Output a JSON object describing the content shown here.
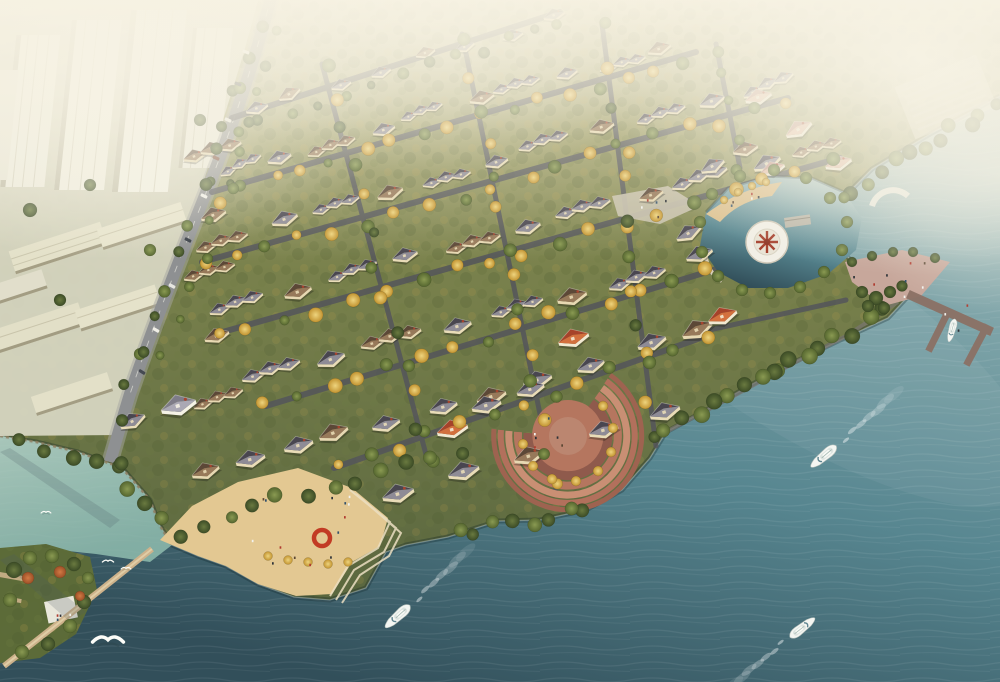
{
  "scene": {
    "title": "Aerial rendering of a lakeside villa community",
    "description": "Bird's-eye architectural visualization in hazy autumn light: a dense European-style villa estate on a promontory surrounded by teal water, with a high-rise city district to the upper left, golden tree-lined streets, a waterfront amphitheater, a beach plaza with a red ring sculpture, a circular lagoon viewing platform, a boat dock, yachts with wakes and seagulls over the water.",
    "regions": {
      "upper_left": "hazy high-rise towers and mid-rise apartment slabs beside a curving arterial road",
      "center": "grid of gabled villas and townhouses with rows of golden autumn trees",
      "upper_right": "fog-covered manor houses with pink roofs and terraced lot",
      "right": "inner lagoon with circular platform, pink waterfront plaza, promontory point and T-shaped boat dock",
      "lower_center": "crescent waterfront amphitheater with terracotta steps",
      "lower_left": "sandy beach plaza, red ring sculpture, boardwalk, small tree park peninsula and cove"
    },
    "objects": {
      "yachts_cruising": 3,
      "boat_moored_at_dock": 1,
      "seagulls": 4,
      "circular_viewing_platform": 1,
      "waterfront_amphitheater": 1,
      "beach_plaza": 1,
      "red_ring_sculpture": 1,
      "boardwalk": 1,
      "boat_dock": 1,
      "highrise_towers": 4,
      "apartment_slabs": 6,
      "villas_approx": 90
    }
  },
  "colors": {
    "haze": "#f6f1df",
    "water_light": "#b9cdc9",
    "water_mid": "#578690",
    "water_deep": "#324f5a",
    "cove": "#a9cdbd",
    "foliage_green": "#68763c",
    "foliage_gold": "#d4a94e",
    "foliage_dark": "#46552e",
    "roof_grey": "#494650",
    "roof_brown": "#5c4837",
    "roof_red": "#a6432a",
    "roof_pink": "#c3948a",
    "wall_cream": "#e9dcb8",
    "sand": "#e3c892",
    "plaza_pink": "#c7a79b",
    "terrace_red": "#b5765f",
    "road": "#8e9092",
    "city_block": "#e7e4d2",
    "boat_white": "#f4f6f2",
    "sculpture_red": "#c23b24"
  }
}
